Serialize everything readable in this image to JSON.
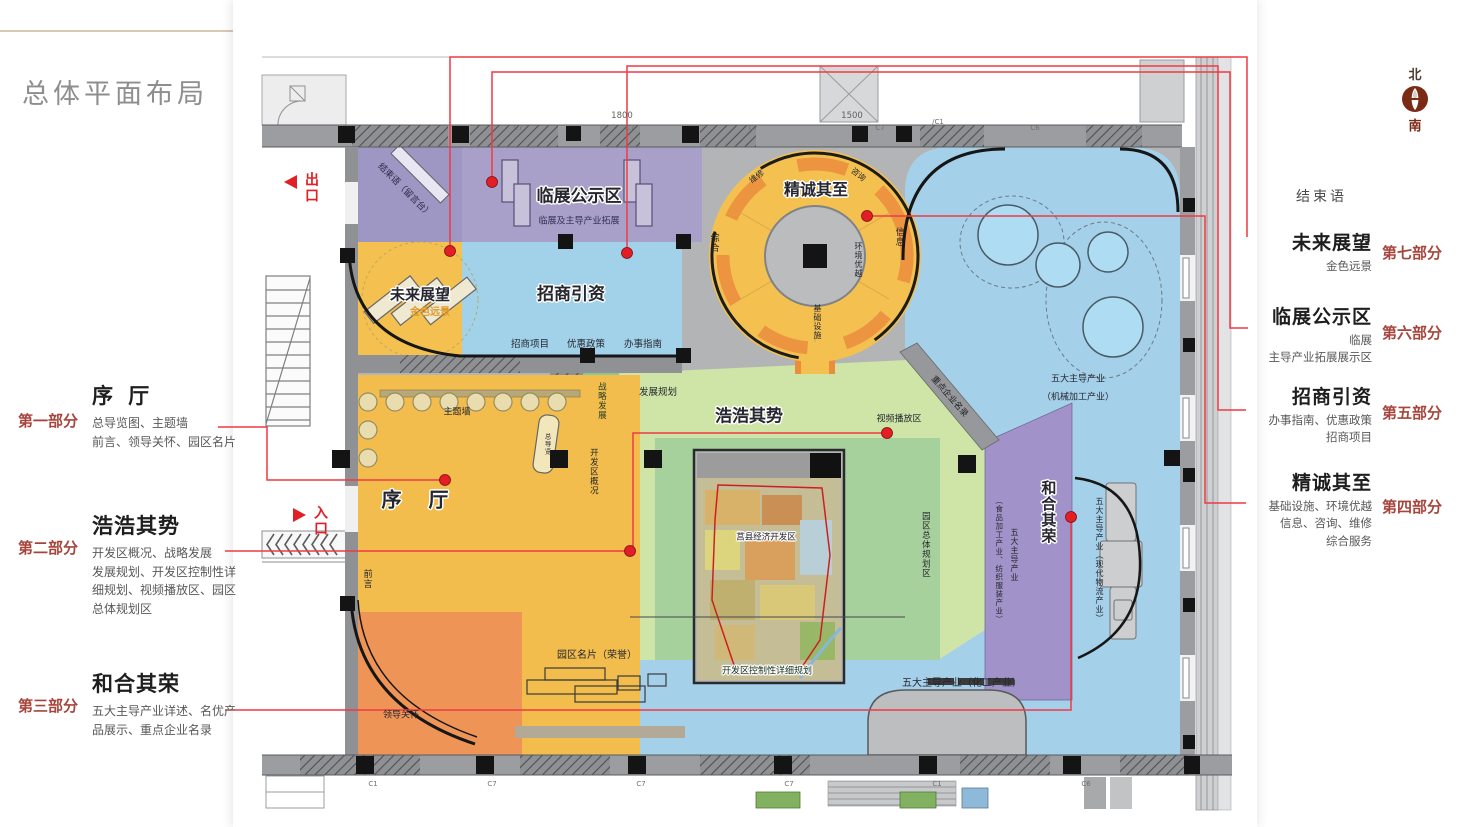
{
  "page": {
    "title": "总体平面布局"
  },
  "compass": {
    "north": "北",
    "south": "南"
  },
  "left_annotations": [
    {
      "part": "第一部分",
      "title": "序 厅",
      "desc": "总导览图、主题墙\n前言、领导关怀、园区名片"
    },
    {
      "part": "第二部分",
      "title": "浩浩其势",
      "desc": "开发区概况、战略发展\n发展规划、开发区控制性详\n细规划、视频播放区、园区\n总体规划区"
    },
    {
      "part": "第三部分",
      "title": "和合其荣",
      "desc": "五大主导产业详述、名优产\n品展示、重点企业名录"
    }
  ],
  "right_annotations": {
    "ending": "结束语",
    "items": [
      {
        "part": "第七部分",
        "title": "未来展望",
        "desc": "金色远景"
      },
      {
        "part": "第六部分",
        "title": "临展公示区",
        "desc": "临展\n主导产业拓展展示区"
      },
      {
        "part": "第五部分",
        "title": "招商引资",
        "desc": "办事指南、优惠政策\n招商项目"
      },
      {
        "part": "第四部分",
        "title": "精诚其至",
        "desc": "基础设施、环境优越\n信息、咨询、维修\n综合服务"
      }
    ]
  },
  "plan": {
    "exit": "出口",
    "entry": "入口",
    "zones": {
      "linzhan": {
        "title": "临展公示区",
        "sub": "临展及主导产业拓展"
      },
      "jieshu_desk": "结束语（留言台）",
      "jingcheng": {
        "title": "精诚其至",
        "zonghe": "综合",
        "xinxi": "信息",
        "weixiu": "维修",
        "zixun": "咨询",
        "huanjing": "环境优越",
        "jichu": "基础设施"
      },
      "weilai": {
        "title": "未来展望",
        "sub": "金色远景"
      },
      "zhaoshang": {
        "title": "招商引资",
        "item1": "招商项目",
        "item2": "优惠政策",
        "item3": "办事指南"
      },
      "xuting": {
        "title": "序 厅",
        "zhutiqiang": "主题墙",
        "zongdaolan": "总导览",
        "qianyan": "前言",
        "lingdao": "领导关怀",
        "mingpian": "园区名片（荣誉）"
      },
      "haohao": {
        "title": "浩浩其势",
        "fazhan": "发展规划",
        "zhanlue": "战略发展",
        "gaikuang": "开发区概况",
        "shipin": "视频播放区",
        "yuanqu": "园区总体规划区",
        "zhongdian": "重点企业名录"
      },
      "map": {
        "title": "莒县经济开发区",
        "caption": "开发区控制性详细规划"
      },
      "hehe": {
        "title": "和合其荣",
        "col1": "五大主导产业",
        "col2": "（食品加工产业、纺织服装产业）"
      },
      "wuliu": "五大主导产业（现代物流产业）",
      "jixie": {
        "line1": "五大主导产业",
        "line2": "（机械加工产业）"
      },
      "huagong": "五大主导产业（化工产业）"
    },
    "dims": [
      "1800",
      "1500"
    ],
    "cols_top": [
      "C7",
      "C7",
      "C7",
      "C7",
      "/C1",
      "C6",
      "C6"
    ],
    "cols_bottom": [
      "C1",
      "C7",
      "C7",
      "C7",
      "C1",
      "C6"
    ]
  }
}
